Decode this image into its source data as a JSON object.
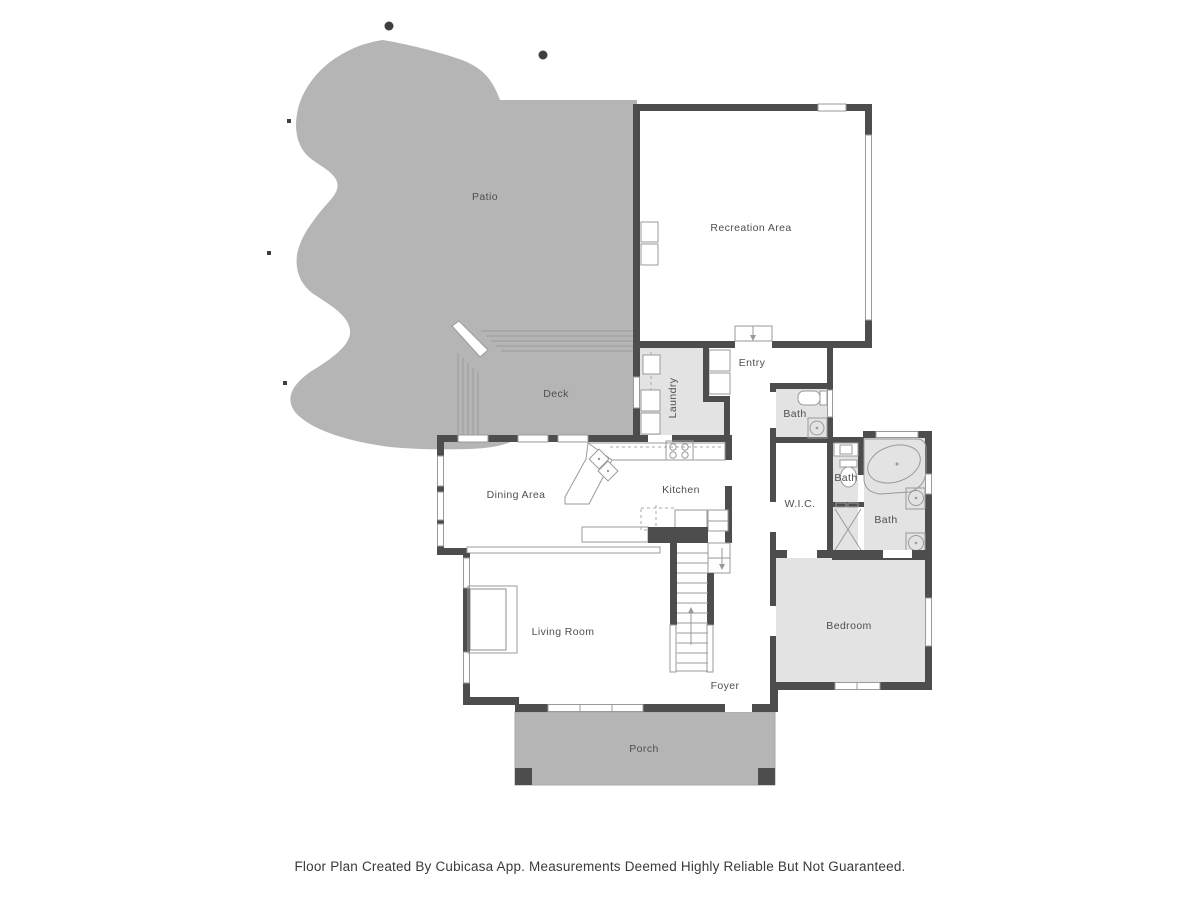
{
  "plan": {
    "title": "Cubicasa floor plan",
    "rooms": {
      "patio": {
        "label": "Patio"
      },
      "recreation": {
        "label": "Recreation Area"
      },
      "entry": {
        "label": "Entry"
      },
      "deck": {
        "label": "Deck"
      },
      "laundry": {
        "label": "Laundry"
      },
      "bath_top": {
        "label": "Bath"
      },
      "bath_mid": {
        "label": "Bath"
      },
      "bath_main": {
        "label": "Bath"
      },
      "dining": {
        "label": "Dining Area"
      },
      "kitchen": {
        "label": "Kitchen"
      },
      "wic": {
        "label": "W.I.C."
      },
      "living": {
        "label": "Living Room"
      },
      "bedroom": {
        "label": "Bedroom"
      },
      "foyer": {
        "label": "Foyer"
      },
      "porch": {
        "label": "Porch"
      }
    },
    "colors": {
      "wall": "#4d4d4d",
      "outdoor_fill": "#b5b5b5",
      "room_light_fill": "#e3e3e3",
      "room_white_fill": "#ffffff",
      "fixture_line": "#9a9a9a",
      "label_text": "#4f4f4f"
    }
  },
  "footer": {
    "text": "Floor Plan Created By Cubicasa App. Measurements Deemed Highly Reliable But Not Guaranteed."
  }
}
